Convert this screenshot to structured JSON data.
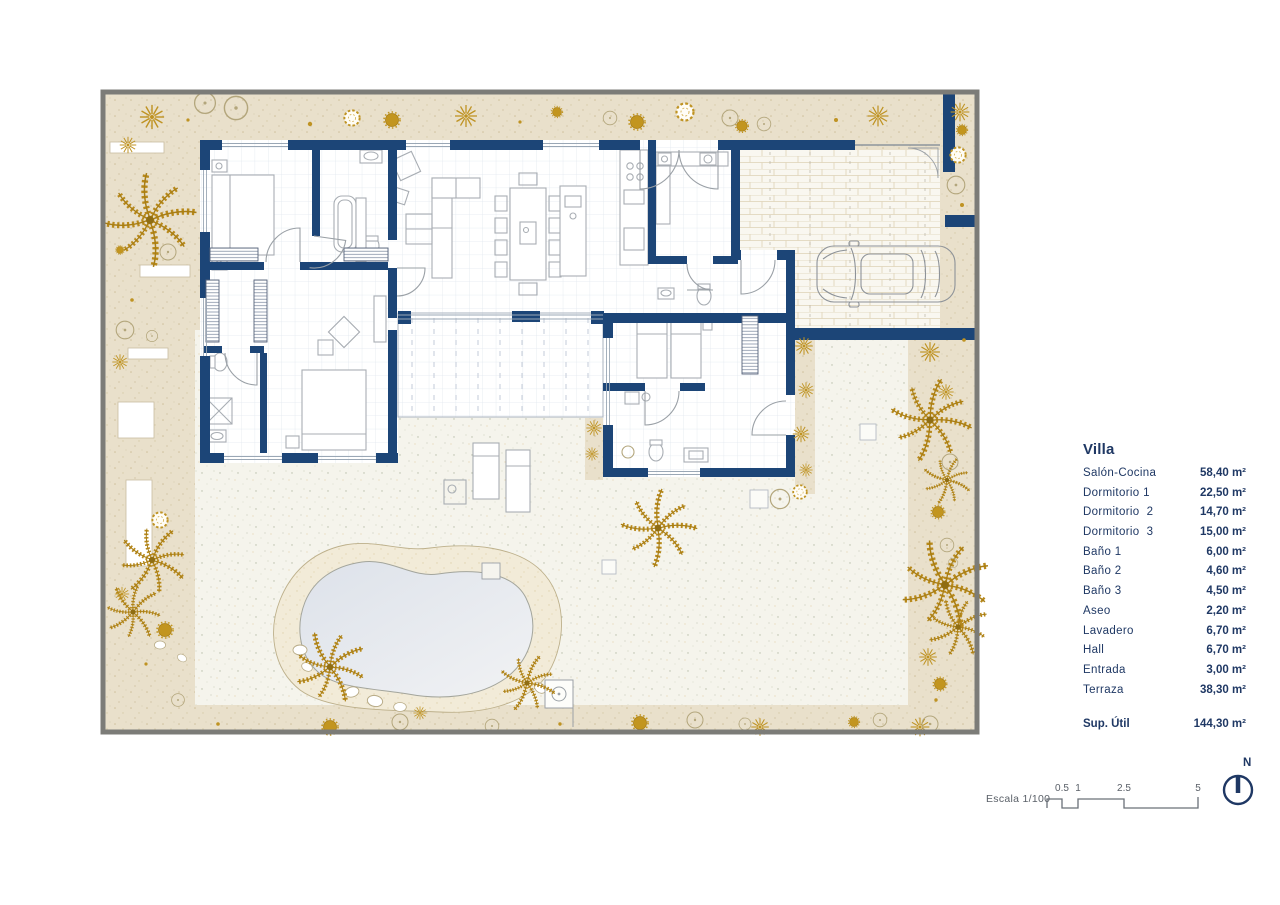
{
  "legend": {
    "title": "Villa",
    "rooms": [
      {
        "name": "Salón-Cocina",
        "area": "58,40 m²"
      },
      {
        "name": "Dormitorio 1",
        "area": "22,50 m²"
      },
      {
        "name": "Dormitorio  2",
        "area": "14,70 m²"
      },
      {
        "name": "Dormitorio  3",
        "area": "15,00 m²"
      },
      {
        "name": "Baño 1",
        "area": "6,00 m²"
      },
      {
        "name": "Baño 2",
        "area": "4,60 m²"
      },
      {
        "name": "Baño 3",
        "area": "4,50 m²"
      },
      {
        "name": "Aseo",
        "area": "2,20 m²"
      },
      {
        "name": "Lavadero",
        "area": "6,70 m²"
      },
      {
        "name": "Hall",
        "area": "6,70 m²"
      },
      {
        "name": "Entrada",
        "area": "3,00 m²"
      },
      {
        "name": "Terraza",
        "area": "38,30 m²"
      }
    ],
    "total_label": "Sup. Útil",
    "total_area": "144,30 m²"
  },
  "scale_bar": {
    "label": "Escala 1/100",
    "ticks": [
      "0.5",
      "1",
      "2.5",
      "5"
    ]
  },
  "north_label": "N",
  "colors": {
    "wall_navy": "#1c4577",
    "plant_gold": "#bf9323",
    "gravel_beige": "#e9e0cb",
    "terrace_cream": "#f5f4ec",
    "pool_water": "#e0e4eb",
    "sand": "#f2ebd8",
    "frame_gray": "#7c7c78",
    "text_navy": "#1f3864",
    "scale_gray": "#5a6068"
  }
}
